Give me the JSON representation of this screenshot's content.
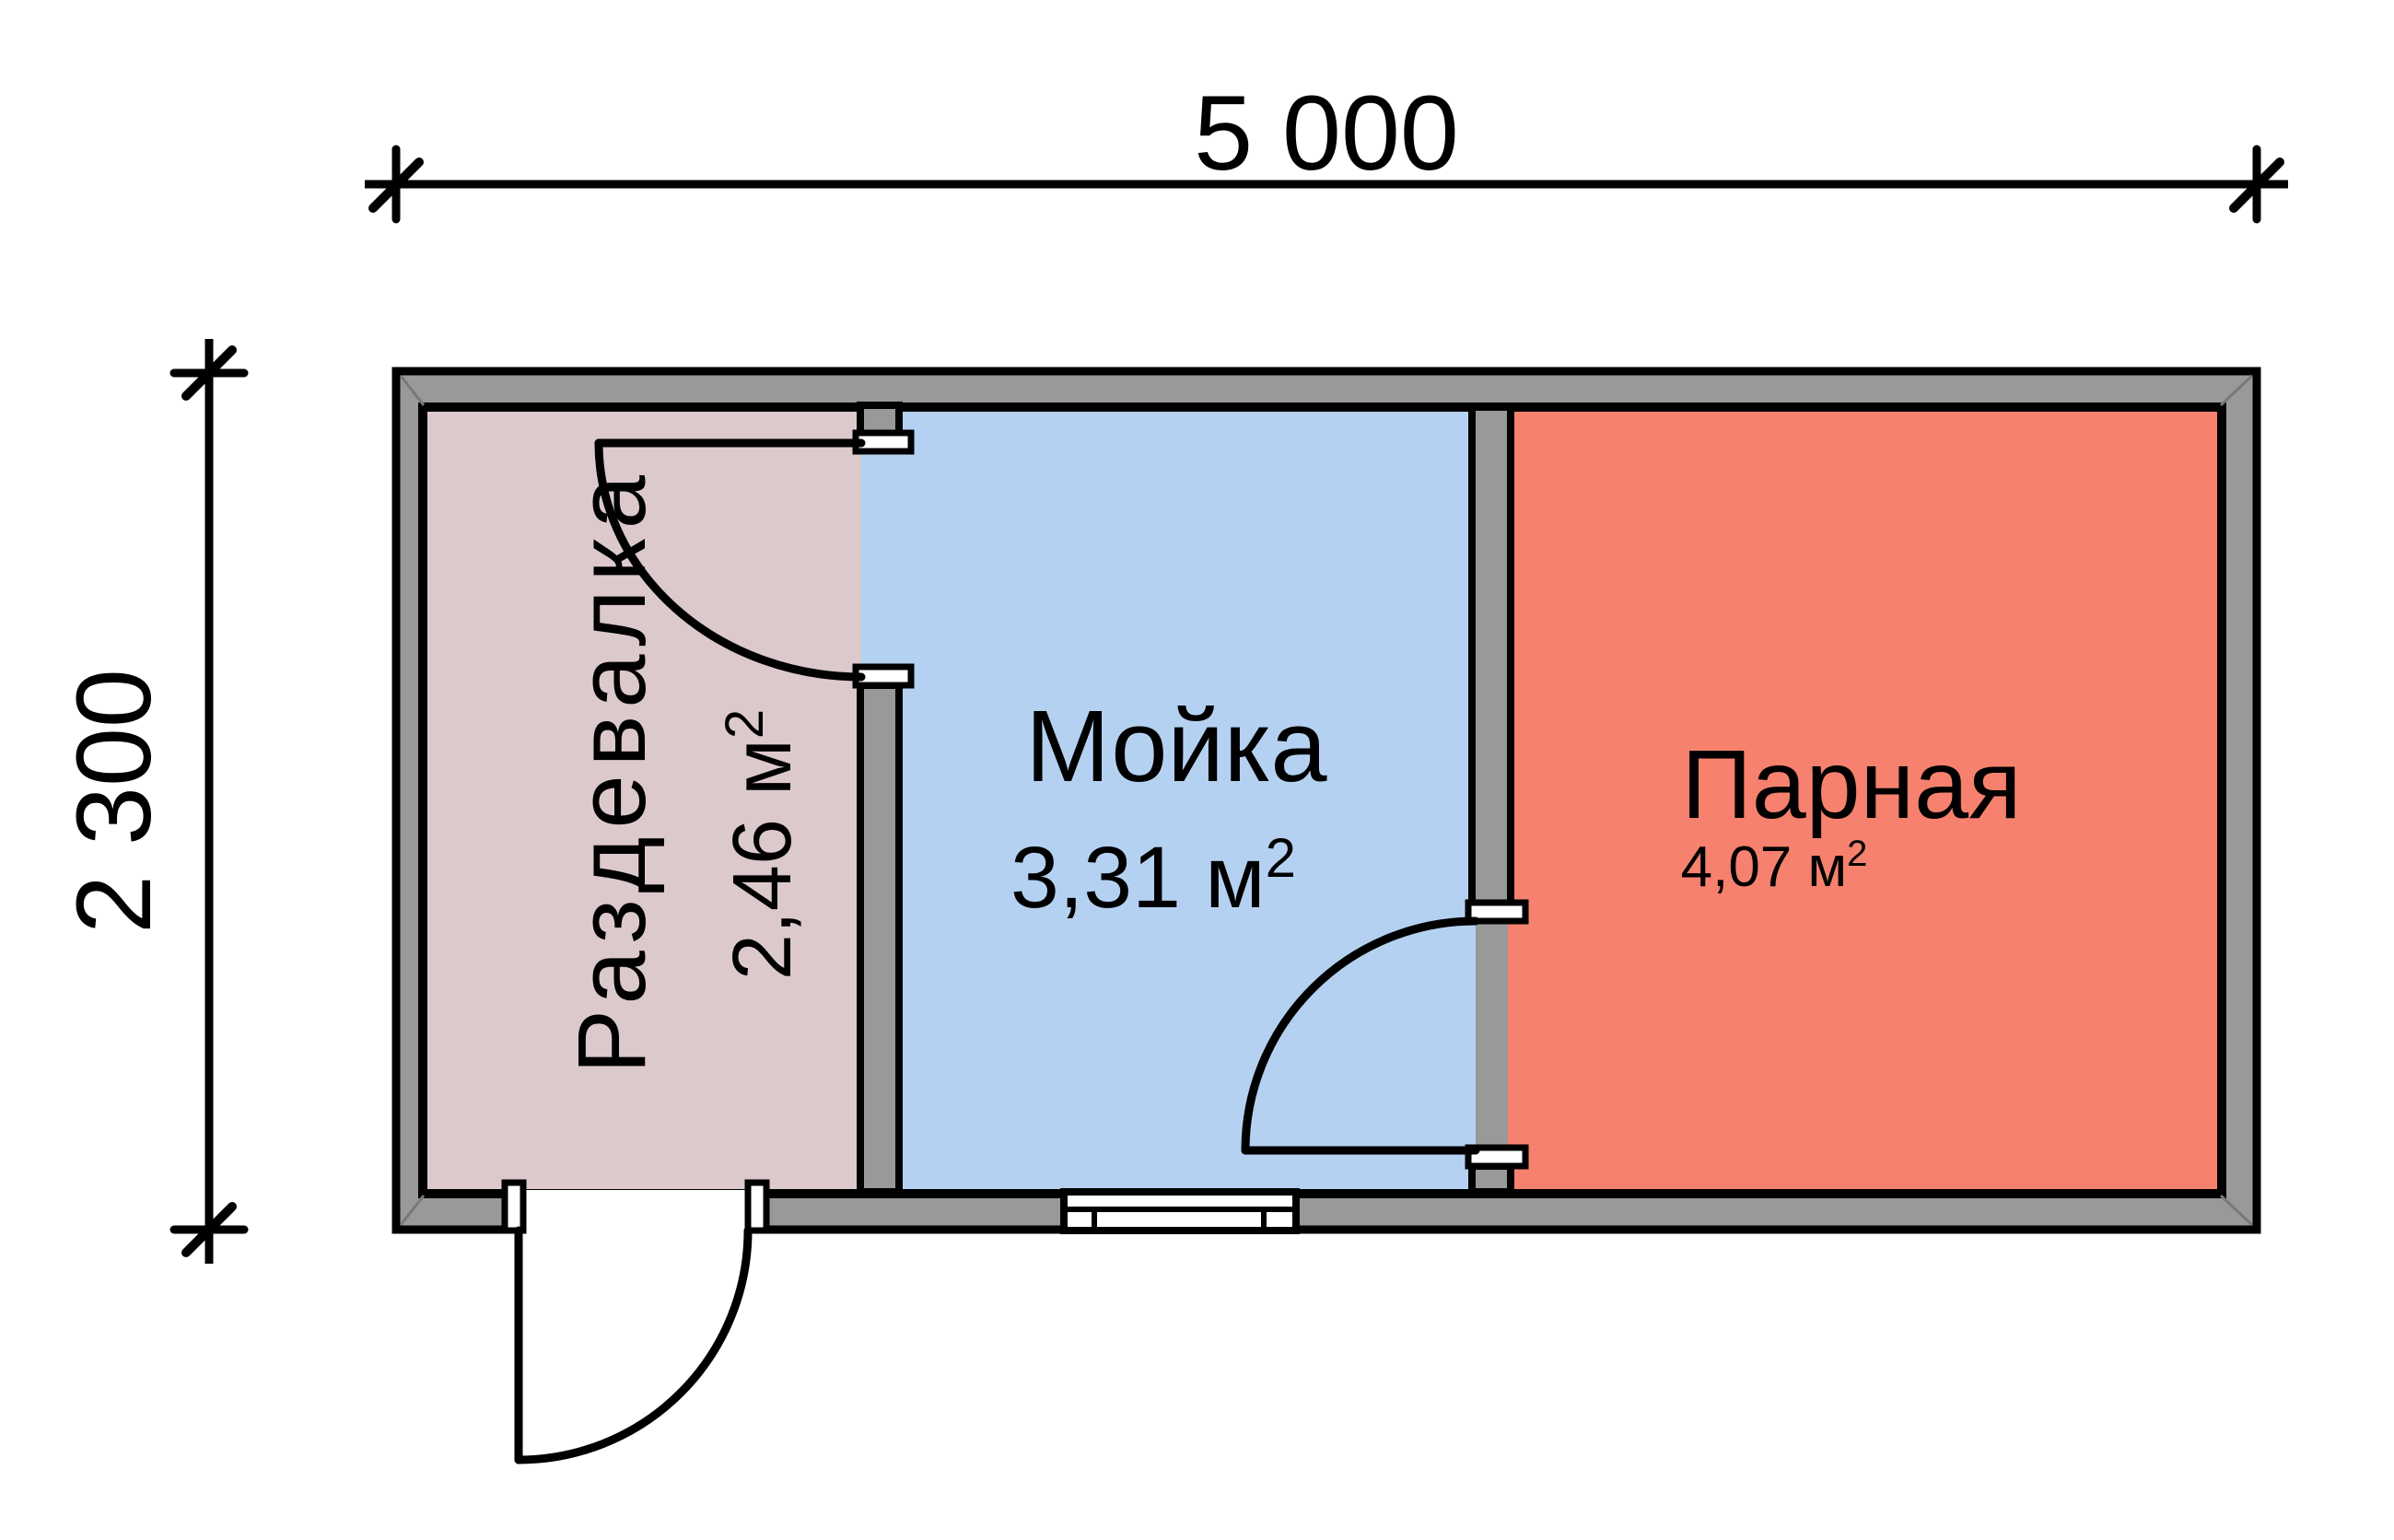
{
  "diagram": {
    "type": "bath-house floor plan",
    "overall_width": "5 000",
    "overall_depth": "2 300"
  },
  "dimensions": {
    "top_label": "5 000",
    "left_label": "2 300"
  },
  "rooms": [
    {
      "name": "Раздевалка",
      "area_label": "2,46 м",
      "area_sup": "2",
      "fill": "#dcc9cc"
    },
    {
      "name": "Мойка",
      "area_label": "3,31 м",
      "area_sup": "2",
      "fill": "#b5d1f2"
    },
    {
      "name": "Парная",
      "area_label": "4,07 м",
      "area_sup": "2",
      "fill": "#f6816e"
    }
  ],
  "colors": {
    "wall": "#999999",
    "wall_bevel": "#787878",
    "line": "#000000",
    "opening": "#ffffff"
  }
}
